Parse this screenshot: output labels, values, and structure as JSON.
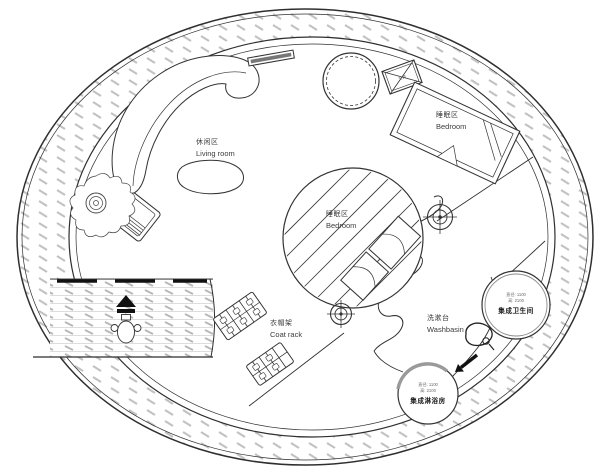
{
  "drawing": "circular-house-floor-plan",
  "labels": {
    "living_room": {
      "zh": "休闲区",
      "en": "Living room"
    },
    "bedroom_main": {
      "zh": "睡眠区",
      "en": "Bedroom"
    },
    "bedroom_center": {
      "zh": "睡眠区",
      "en": "Bedroom"
    },
    "coat_rack": {
      "zh": "衣帽架",
      "en": "Coat rack"
    },
    "washbasin": {
      "zh": "洗漱台",
      "en": "Washbasin"
    },
    "bathroom_pod": {
      "spec_diameter": "直径: 1100",
      "spec_height": "高: 2100",
      "name": "集成卫生间"
    },
    "shower_pod": {
      "spec_diameter": "直径: 1100",
      "spec_height": "高: 2100",
      "name": "集成淋浴房"
    },
    "ac_unit": "空调"
  },
  "colors": {
    "line": "#2f2f2f",
    "hatch": "#c2c2c2",
    "text": "#3c3c3c"
  }
}
